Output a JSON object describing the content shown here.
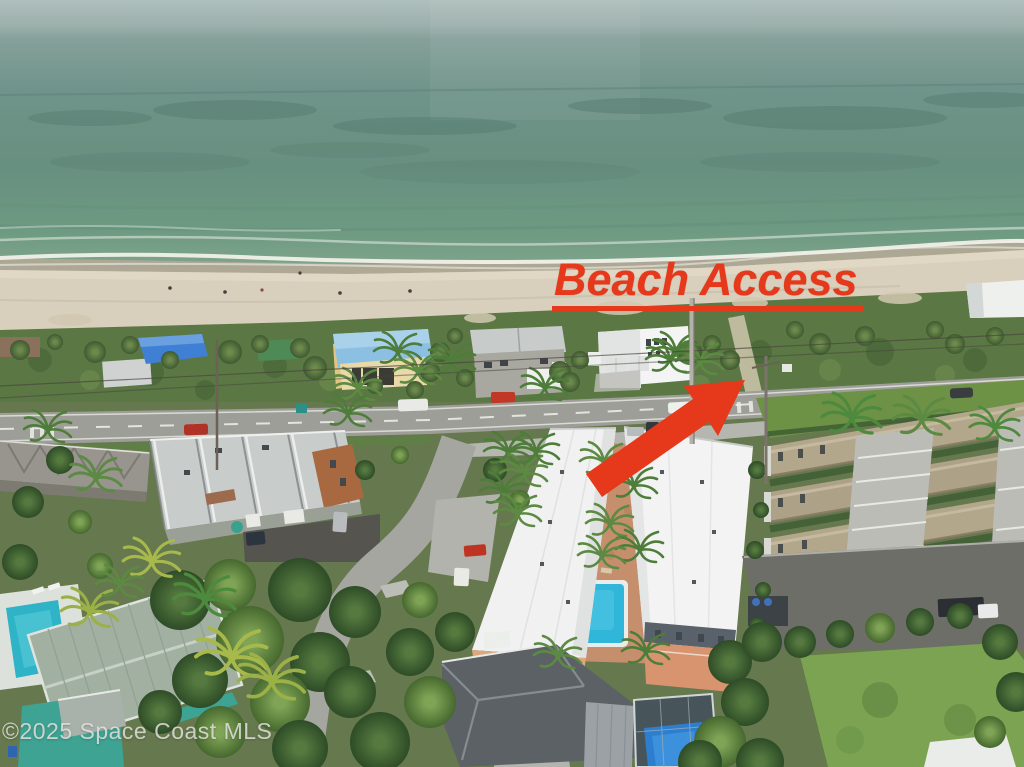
{
  "photo": {
    "kind": "aerial-drone-photo",
    "alt": "Aerial view of oceanfront neighborhood: ocean and surf at top, sandy beach, dune vegetation, coastal road A1A with houses, white-roofed subject buildings with courtyard pool, tan condo complex, tropical trees and pools below"
  },
  "annotations": {
    "beach_access": {
      "label": "Beach Access",
      "color": "#e6381a",
      "underline": true
    },
    "arrow": {
      "color": "#e6381a",
      "direction": "up-right toward beach access path"
    }
  },
  "watermark": {
    "text": "©2025 Space Coast MLS",
    "color": "#e6e6e0"
  },
  "palette": {
    "ocean": "#6f948a",
    "sky_haze": "#adbdbb",
    "surf_foam": "#f4f3ec",
    "sand": "#d8cfbc",
    "dune_vegetation": "#5b7844",
    "road": "#9e9e99",
    "asphalt": "#5b5b54",
    "concrete": "#b6b6b0",
    "white_roof": "#f1f2f1",
    "condo_roof_tan": "#b2a68b",
    "townhouse_roof_gray": "#c8ccca",
    "brick": "#a86840",
    "pool_blue": "#2fb6d9",
    "enclosed_pool_blue": "#2e7ed0",
    "teal_house": "#3ea393",
    "lawn": "#7ba351",
    "tree_green": "#3c5c30"
  }
}
